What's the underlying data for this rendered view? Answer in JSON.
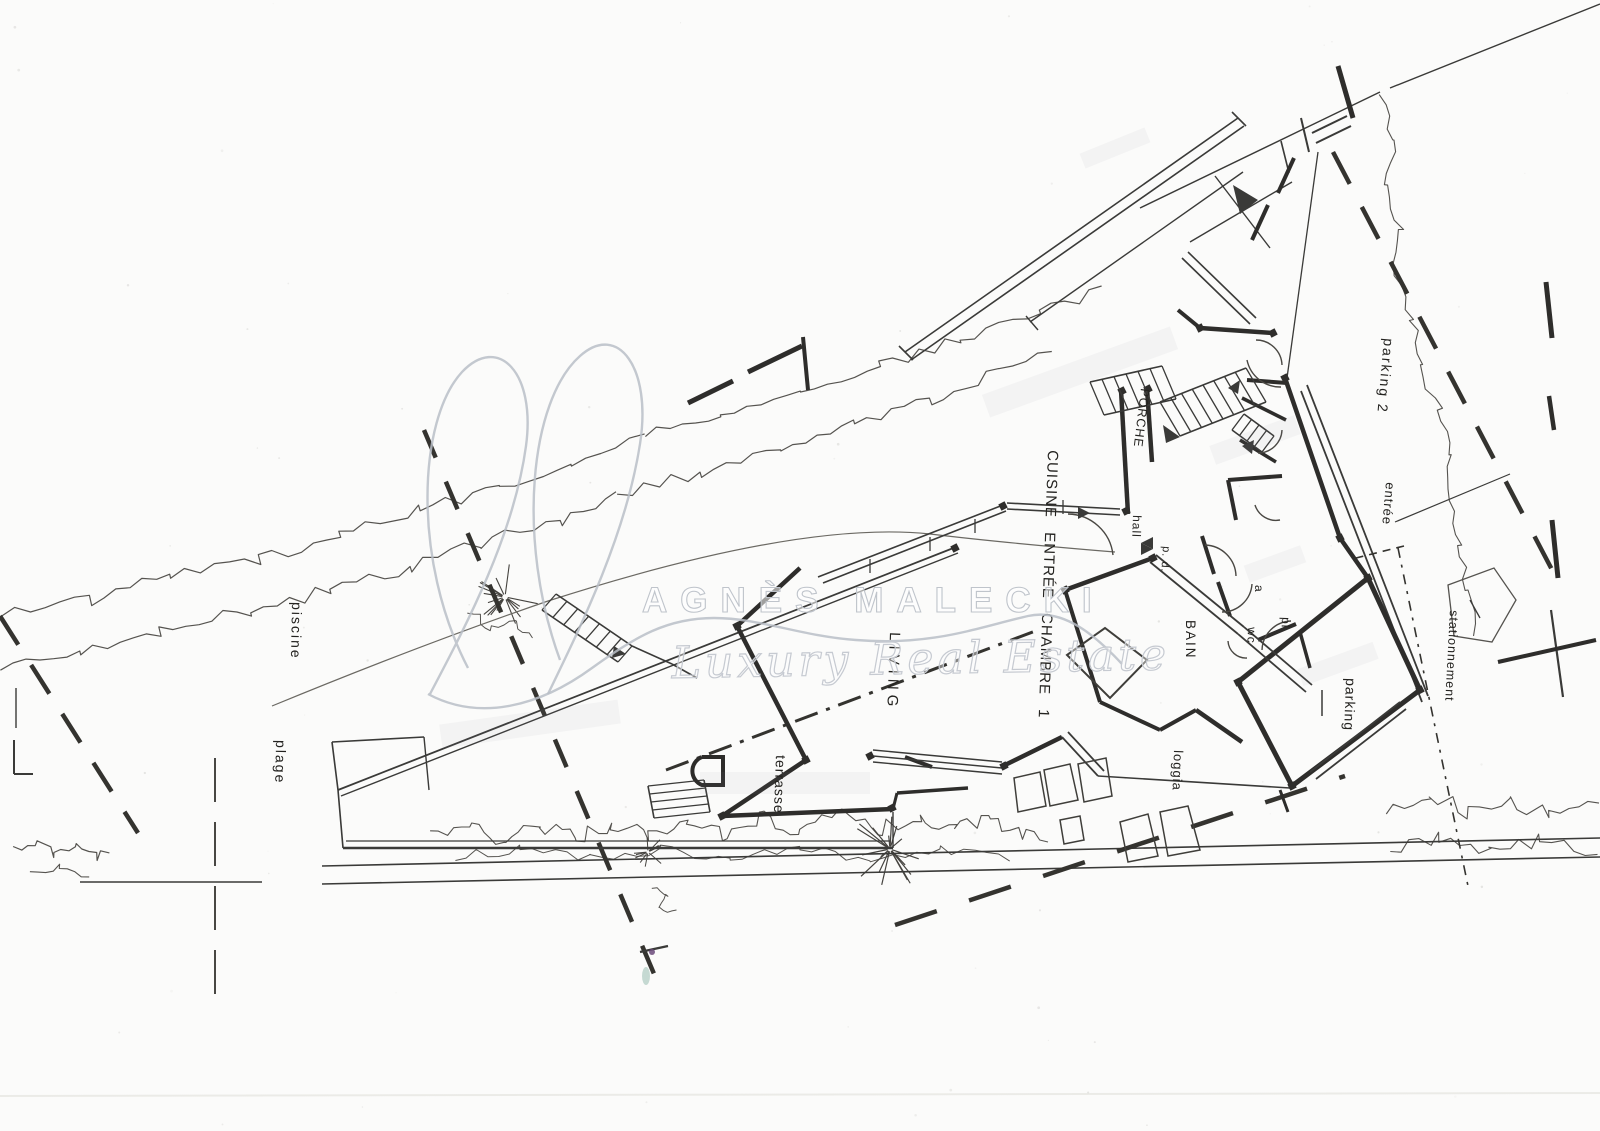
{
  "watermark": {
    "name": "AGNÈS MALECKI",
    "tagline": "Luxury Real Estate"
  },
  "labels": {
    "piscine": "piscine",
    "plage": "plage",
    "terrasse": "terrasse",
    "living": "LIVING",
    "rooms_band": "CUISINE ENTRÉE CHAMBRE 1",
    "porche": "PORCHE",
    "hall": "hall",
    "pd": "p. d.",
    "bain": "BAIN",
    "a": "a",
    "wc": "wc",
    "pl": "pl",
    "loggia": "loggia",
    "parking": "parking",
    "parking2": "parking 2",
    "entree": "entrée",
    "stationnement": "stationnement"
  }
}
